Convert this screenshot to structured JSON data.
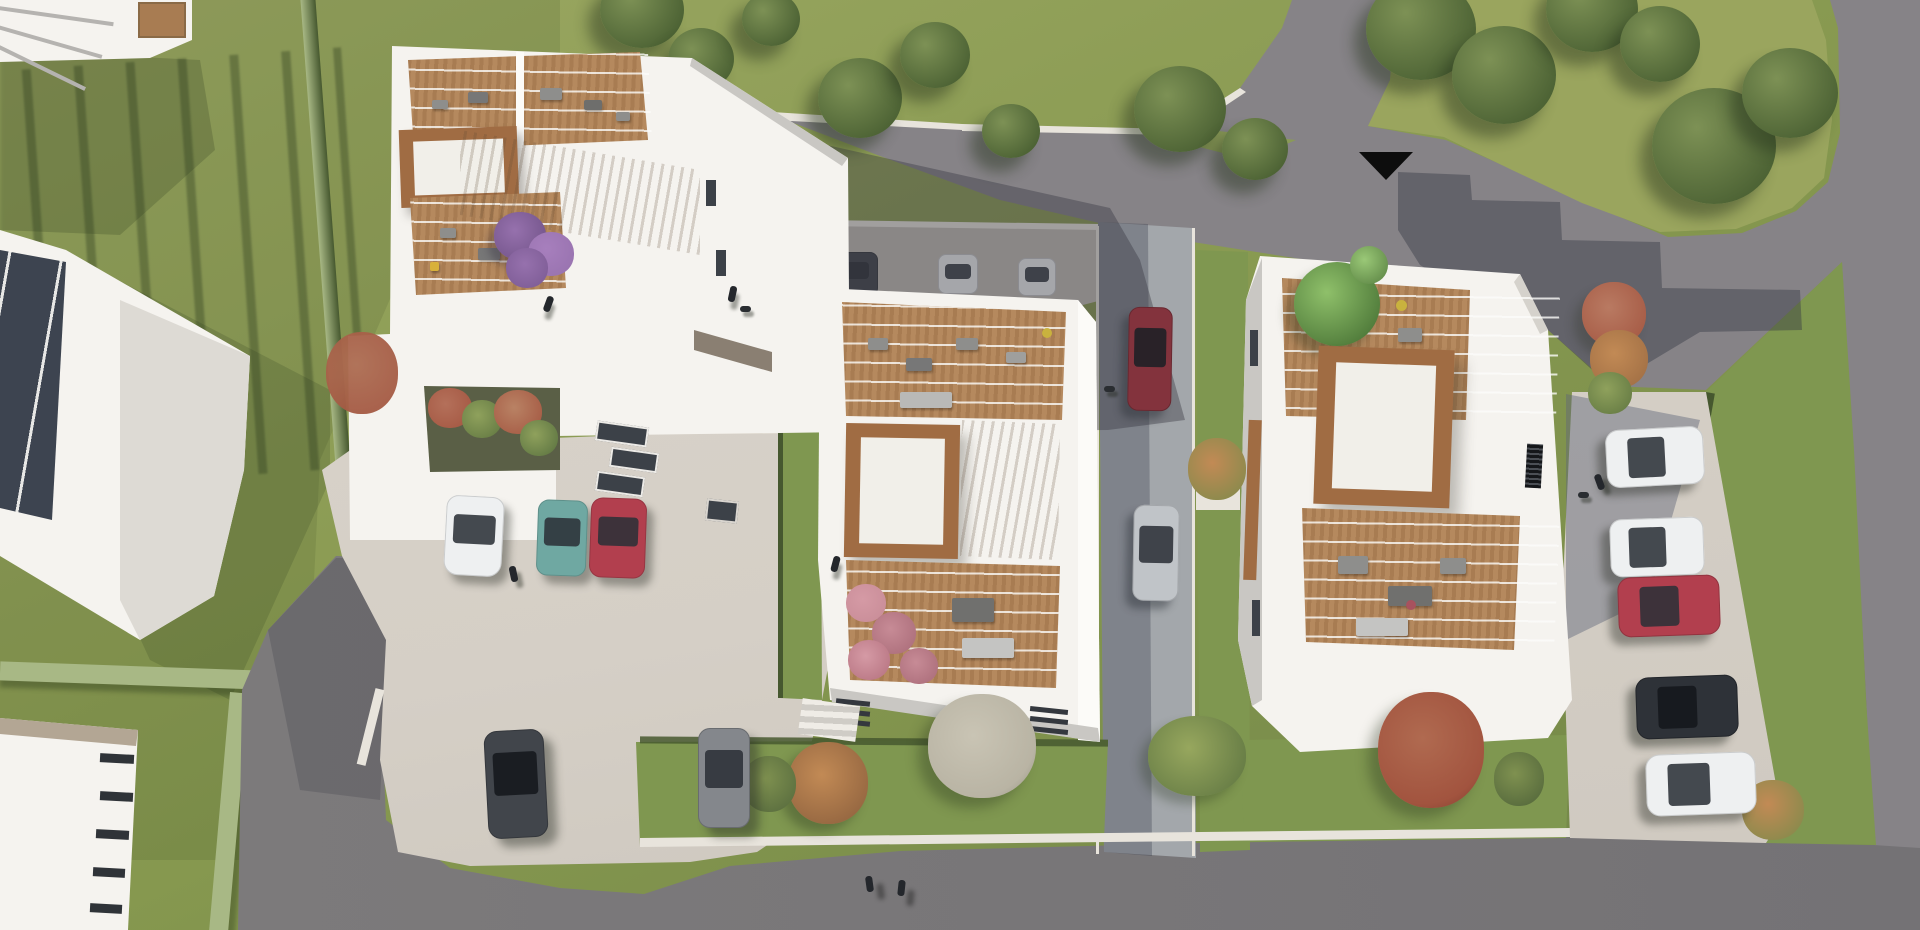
{
  "scene": {
    "description": "Aerial 3D architectural rendering of a residential development: three white flat-roofed apartment buildings with rooftop wooden deck terraces, pergolas and skylight boxes, surrounded by lawns, hedges, parking lots with cars, access roads, trees and small human figures. A black triangular marker floats over the road at the top right.",
    "marker": {
      "label": "Black triangular site marker",
      "color": "#0d0d0d"
    },
    "buildings": [
      {
        "id": "building-left",
        "label": "Building 1 (left) - rooftop terraces with pergolas and stair box"
      },
      {
        "id": "building-middle",
        "label": "Building 2 (middle) - rooftop skylight box and two deck terraces"
      },
      {
        "id": "building-right",
        "label": "Building 3 (right) - rooftop terrace with tree and skylight box"
      },
      {
        "id": "neighbor-top-left",
        "label": "Neighboring house (top left) with pergola"
      },
      {
        "id": "neighbor-mid-left",
        "label": "Neighboring house (mid left) with glazed facade"
      },
      {
        "id": "neighbor-bottom-left",
        "label": "Neighboring house (bottom left) with slit windows"
      }
    ],
    "areas": {
      "top_road": "Access road (north)",
      "bottom_road": "Street (south)",
      "main_parking": "Main parking lot",
      "upper_parking": "Upper parking spaces",
      "right_parking": "East parking spaces",
      "driveway": "Central driveway",
      "island": "Green island with trees",
      "left_garden": "Neighboring gardens with hedges"
    },
    "cars": [
      {
        "id": "white-car-left-lot",
        "label": "White car - left parking row"
      },
      {
        "id": "teal-car-left-lot",
        "label": "Teal car - left parking row"
      },
      {
        "id": "red-car-left-lot",
        "label": "Red car - left parking row"
      },
      {
        "id": "dark-suv-left-lot",
        "label": "Dark gray car - left parking south row"
      },
      {
        "id": "gray-car-left-lot",
        "label": "Gray car - left parking south row"
      },
      {
        "id": "dark-car-upper-lot",
        "label": "Dark car - upper parking"
      },
      {
        "id": "white-car-upper-lot-1",
        "label": "White car - upper parking"
      },
      {
        "id": "white-car-upper-lot-2",
        "label": "White car - upper parking"
      },
      {
        "id": "dark-red-car-driveway",
        "label": "Dark red car - central driveway"
      },
      {
        "id": "silver-car-driveway",
        "label": "Silver car - central driveway"
      },
      {
        "id": "white-suv-right-lot",
        "label": "White car - east parking"
      },
      {
        "id": "white-car-right-lot",
        "label": "White car - east parking"
      },
      {
        "id": "red-car-right-lot",
        "label": "Red car - east parking"
      },
      {
        "id": "black-car-right-lot",
        "label": "Black car - east parking"
      },
      {
        "id": "white-sedan-right-lot",
        "label": "White car - east parking south"
      }
    ],
    "figures_count": "9",
    "palette": {
      "grass-light": "#9ca863",
      "grass-base": "#86984f",
      "grass-dark": "#6f8347",
      "grass-bright": "#7f9750",
      "island-grass": "#9aa55e",
      "road": "#868387",
      "road-dark": "#6c6a6f",
      "paving": "#d5cfc6",
      "paving-shade": "#c2bcb4",
      "path": "#dcd6cc",
      "driveway": "#a3a7ab",
      "wall-light": "#e8e4dc",
      "hedge-dark": "#46582f",
      "hedge-light": "#a8b885",
      "building-white": "#f5f3ef",
      "building-lit": "#fcfbf8",
      "building-shade": "#dddad4",
      "facade-gray": "#c9c7c3",
      "wood-deck": "#b5895e",
      "wood-deck-dark": "#a87c52",
      "wood-frame": "#a06c43",
      "skylight": "#f1efe9",
      "tree-light": "#7d9155",
      "tree-dark": "#4c6234",
      "tree-olive": "#8a9a58",
      "shrub-red": "#a2543f",
      "shrub-orange": "#c28a55",
      "shrub-silver": "#b9b4a4",
      "flower-purple": "#9671ad",
      "flower-pink": "#c78b96",
      "glass": "#3d4450",
      "car-white": "#eef0f1",
      "car-teal": "#6fa8a2",
      "car-red": "#b23f4e",
      "car-darkred": "#83333d",
      "car-silver": "#c0c4c8",
      "car-dark": "#41454b",
      "car-gray": "#84878c",
      "car-black": "#2e3238",
      "marker": "#0d0d0d"
    }
  }
}
